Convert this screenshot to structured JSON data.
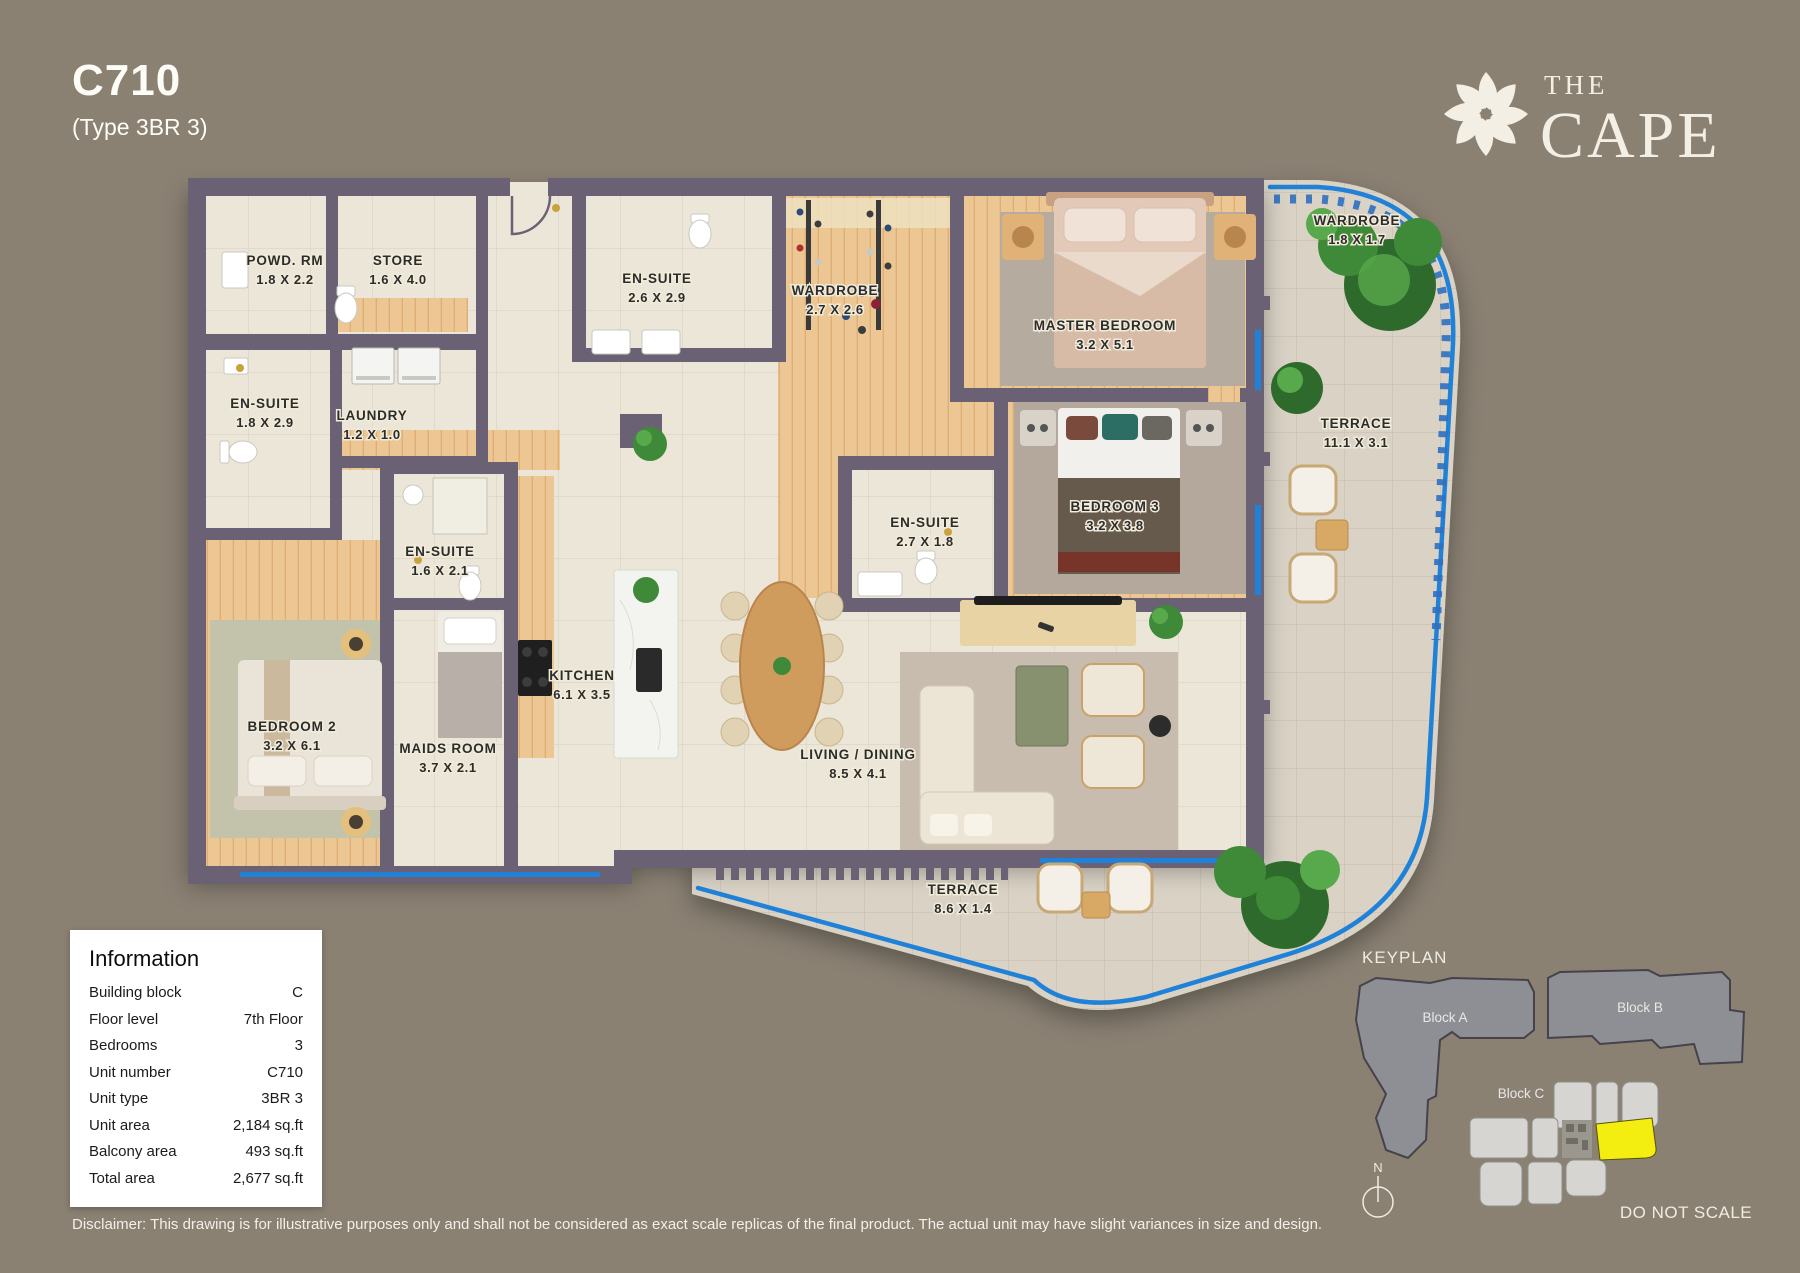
{
  "page": {
    "title": "C710",
    "subtitle": "(Type 3BR 3)"
  },
  "brand": {
    "name_top": "THE",
    "name_bottom": "CAPE",
    "icon": "starburst-flower-icon"
  },
  "floorplan": {
    "rooms": [
      {
        "name": "POWD. RM",
        "dims": "1.8 X 2.2"
      },
      {
        "name": "STORE",
        "dims": "1.6 X 4.0"
      },
      {
        "name": "EN-SUITE",
        "dims": "2.6 X 2.9"
      },
      {
        "name": "WARDROBE",
        "dims": "2.7 X 2.6"
      },
      {
        "name": "MASTER BEDROOM",
        "dims": "3.2 X 5.1"
      },
      {
        "name": "WARDROBE",
        "dims": "1.8 X 1.7"
      },
      {
        "name": "EN-SUITE",
        "dims": "1.8 X 2.9"
      },
      {
        "name": "LAUNDRY",
        "dims": "1.2 X 1.0"
      },
      {
        "name": "TERRACE",
        "dims": "11.1 X 3.1"
      },
      {
        "name": "EN-SUITE",
        "dims": "1.6 X 2.1"
      },
      {
        "name": "EN-SUITE",
        "dims": "2.7 X 1.8"
      },
      {
        "name": "BEDROOM 3",
        "dims": "3.2 X 3.8"
      },
      {
        "name": "KITCHEN",
        "dims": "6.1 X 3.5"
      },
      {
        "name": "MAIDS ROOM",
        "dims": "3.7 X 2.1"
      },
      {
        "name": "BEDROOM 2",
        "dims": "3.2 X 6.1"
      },
      {
        "name": "LIVING / DINING",
        "dims": "8.5 X 4.1"
      },
      {
        "name": "TERRACE",
        "dims": "8.6 X 1.4"
      }
    ]
  },
  "information": {
    "title": "Information",
    "rows": [
      {
        "label": "Building block",
        "value": "C"
      },
      {
        "label": "Floor level",
        "value": "7th Floor"
      },
      {
        "label": "Bedrooms",
        "value": "3"
      },
      {
        "label": "Unit number",
        "value": "C710"
      },
      {
        "label": "Unit type",
        "value": "3BR 3"
      },
      {
        "label": "Unit area",
        "value": "2,184 sq.ft"
      },
      {
        "label": "Balcony area",
        "value": "493 sq.ft"
      },
      {
        "label": "Total area",
        "value": "2,677 sq.ft"
      }
    ]
  },
  "keyplan": {
    "title": "KEYPLAN",
    "blocks": [
      {
        "label": "Block A"
      },
      {
        "label": "Block B"
      },
      {
        "label": "Block C"
      }
    ],
    "do_not_scale": "DO NOT SCALE",
    "compass": "N"
  },
  "disclaimer": "Disclaimer: This drawing is for illustrative purposes only and shall not be considered as exact scale replicas of the final product. The actual unit may have slight variances in size and design.",
  "colors": {
    "background": "#8a8173",
    "walls": "#6a6274",
    "floor_tile": "#ece6d8",
    "wood_floor": "#ecc794",
    "terrace_paver": "#d9d2c5",
    "balcony_line": "#1f82d8",
    "keyplan_highlight": "#f3ee10"
  }
}
